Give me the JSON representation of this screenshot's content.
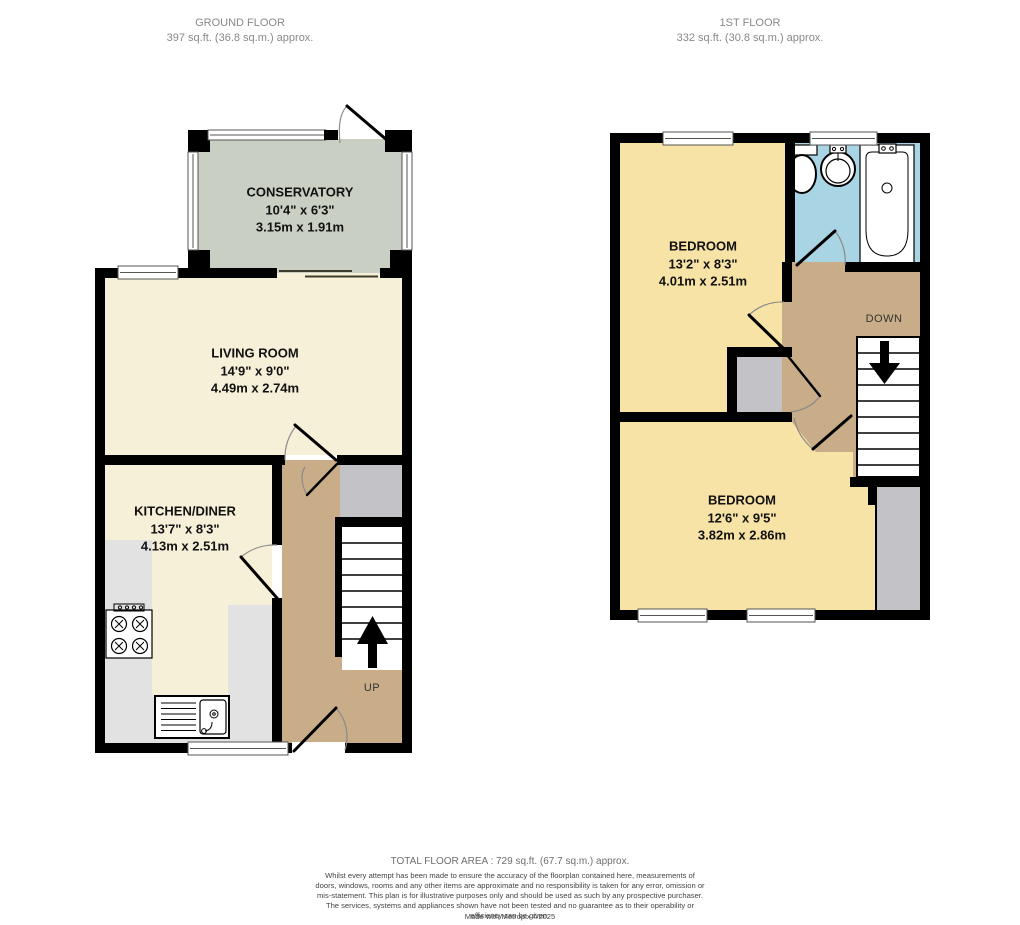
{
  "floors": {
    "ground": {
      "title": "GROUND FLOOR",
      "area": "397 sq.ft. (36.8 sq.m.) approx."
    },
    "first": {
      "title": "1ST FLOOR",
      "area": "332 sq.ft. (30.8 sq.m.) approx."
    }
  },
  "rooms": {
    "conservatory": {
      "name": "CONSERVATORY",
      "imperial": "10'4\" x 6'3\"",
      "metric": "3.15m x 1.91m"
    },
    "living_room": {
      "name": "LIVING ROOM",
      "imperial": "14'9\" x 9'0\"",
      "metric": "4.49m x 2.74m"
    },
    "kitchen_diner": {
      "name": "KITCHEN/DINER",
      "imperial": "13'7\" x 8'3\"",
      "metric": "4.13m x 2.51m"
    },
    "bedroom_1": {
      "name": "BEDROOM",
      "imperial": "13'2\" x 8'3\"",
      "metric": "4.01m x 2.51m"
    },
    "bedroom_2": {
      "name": "BEDROOM",
      "imperial": "12'6\" x 9'5\"",
      "metric": "3.82m x 2.86m"
    }
  },
  "stairs": {
    "up": "UP",
    "down": "DOWN"
  },
  "footer": {
    "total": "TOTAL FLOOR AREA : 729 sq.ft. (67.7 sq.m.) approx.",
    "disclaimer": "Whilst every attempt has been made to ensure the accuracy of the floorplan contained here, measurements of doors, windows, rooms and any other items are approximate and no responsibility is taken for any error, omission or mis-statement. This plan is for illustrative purposes only and should be used as such by any prospective purchaser. The services, systems and appliances shown have not been tested and no guarantee as to their operability or efficiency can be given.",
    "credit": "Made with Metropix ©2025"
  },
  "colors": {
    "wall": "#000000",
    "cream": "#f7f0d8",
    "yellow": "#f7e3a5",
    "sage": "#c9cfc2",
    "tan": "#c8ad88",
    "blue": "#a9d4e4",
    "counter": "#e2e2e2",
    "storage": "#c3c3c7",
    "window_line": "#555555",
    "arc": "#8a8a8a",
    "header_text": "#888888",
    "label_text": "#111111",
    "footer_text": "#444444",
    "stair_text": "#333333"
  }
}
